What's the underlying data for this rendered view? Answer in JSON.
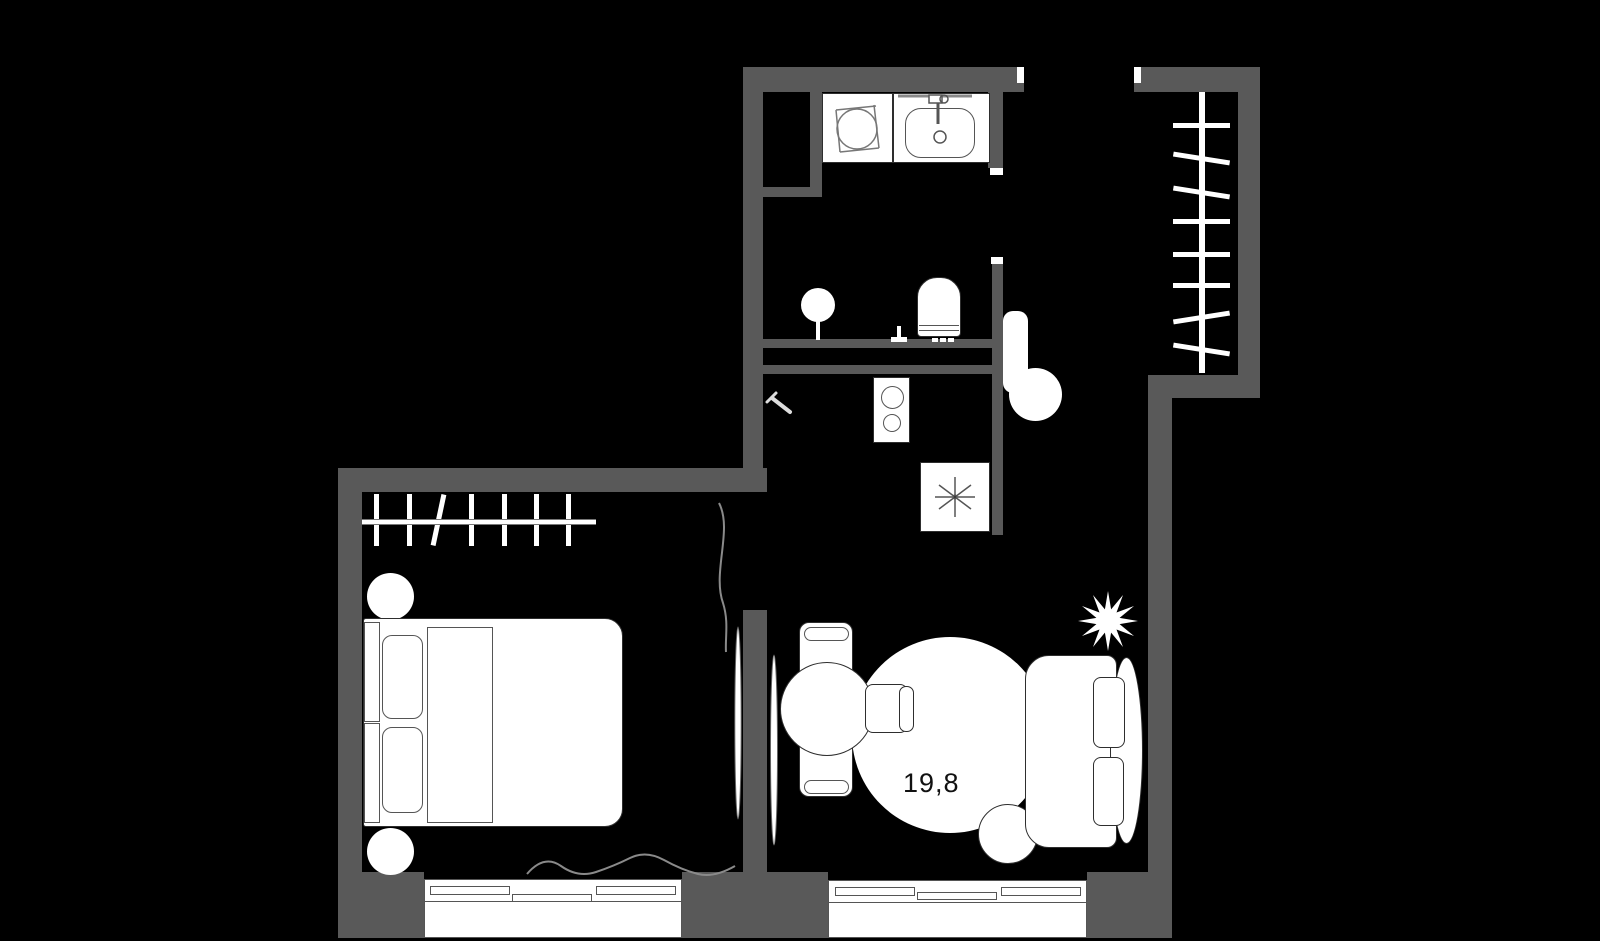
{
  "plan": {
    "living_room_area_label": "19,8"
  },
  "colors": {
    "background": "#000000",
    "wall": "#595959",
    "furniture_fill": "#ffffff",
    "outline": "#2e2e2e",
    "curtain_line": "#8a8a8a",
    "area_text": "#111111"
  }
}
